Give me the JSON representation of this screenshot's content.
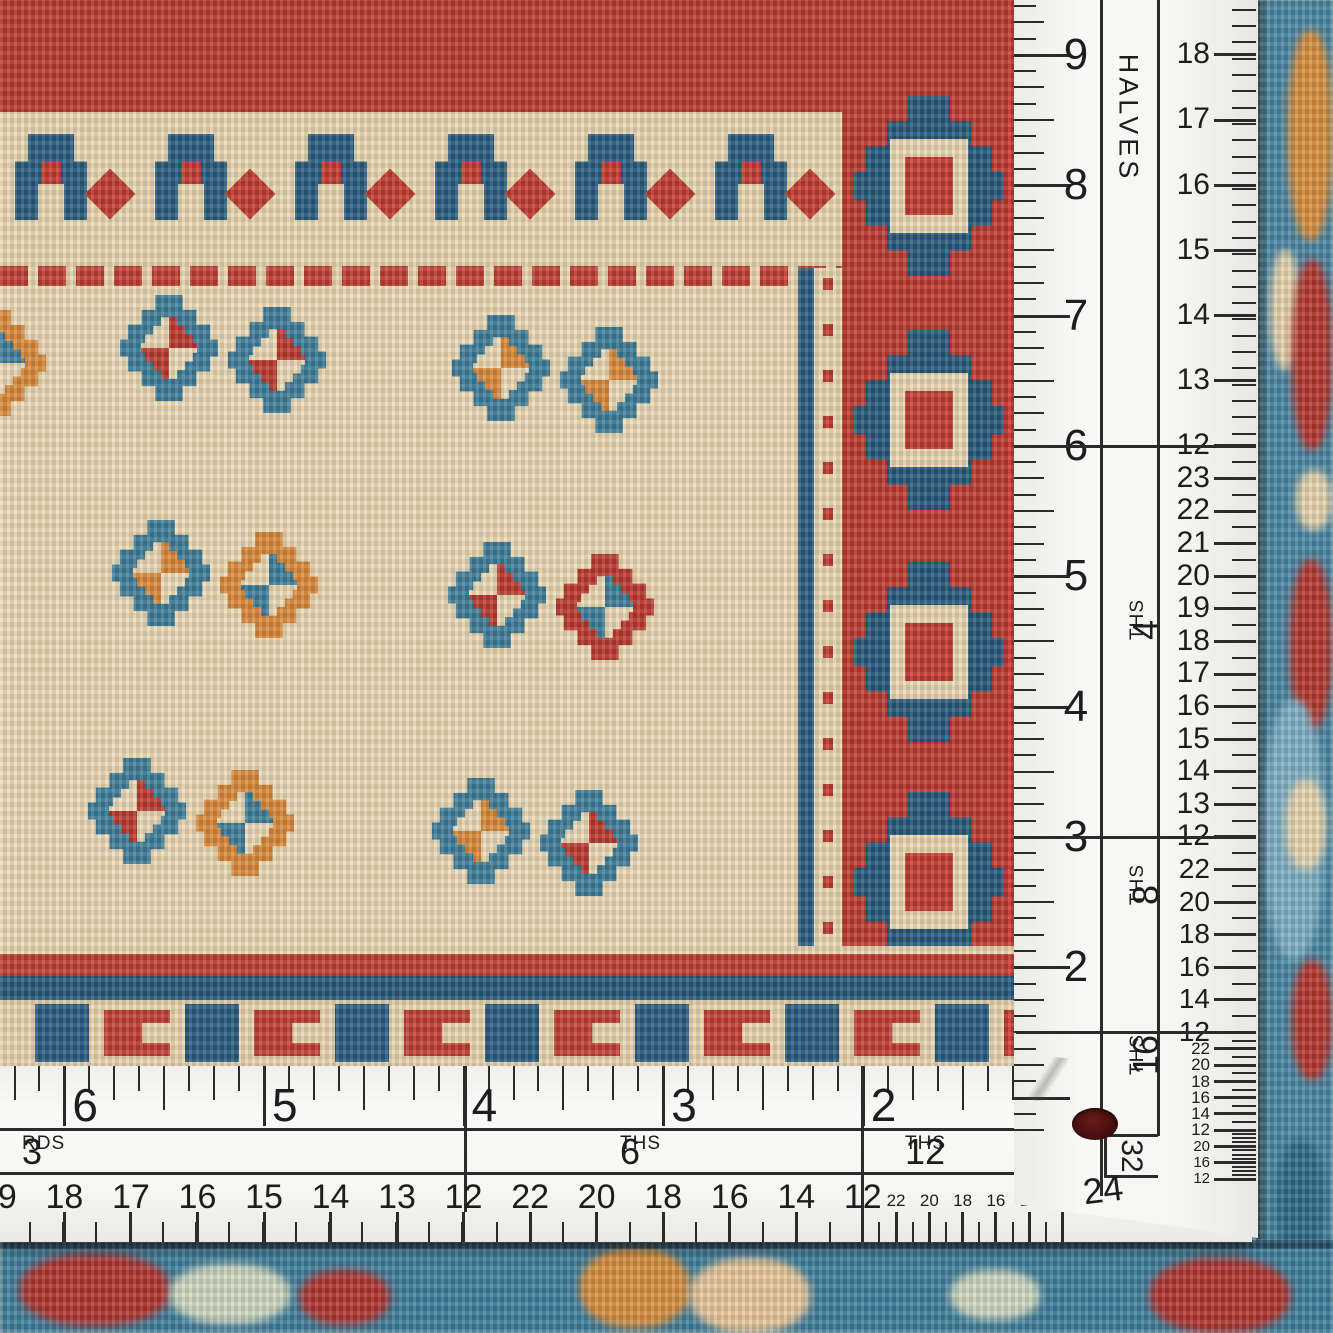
{
  "vertical_ruler": {
    "inch_numbers": [
      "9",
      "8",
      "7",
      "6",
      "5",
      "4",
      "3",
      "2"
    ],
    "sections": [
      {
        "prefix": "",
        "suffix": "HALVES",
        "numbers": [
          "19",
          "18",
          "17",
          "16",
          "15",
          "14",
          "13",
          "12"
        ]
      },
      {
        "prefix": "4",
        "suffix": "THS",
        "numbers": [
          "23",
          "22",
          "21",
          "20",
          "19",
          "18",
          "17",
          "16",
          "15",
          "14",
          "13",
          "12"
        ]
      },
      {
        "prefix": "8",
        "suffix": "THS",
        "numbers": [
          "22",
          "20",
          "18",
          "16",
          "14",
          "12"
        ]
      },
      {
        "prefix": "16",
        "suffix": "THS",
        "numbers": [
          "22",
          "20",
          "18",
          "16",
          "14",
          "12"
        ]
      },
      {
        "prefix": "32",
        "suffix": "",
        "numbers": [
          "20",
          "16",
          "12"
        ]
      }
    ],
    "corner_number_24": "24",
    "corner_number_32": "32"
  },
  "horizontal_ruler": {
    "inch_numbers": [
      "6",
      "5",
      "4",
      "3",
      "2"
    ],
    "sections": [
      {
        "prefix": "3",
        "suffix": "RDS",
        "numbers": [
          "19",
          "18",
          "17",
          "16",
          "15",
          "14",
          "13",
          "12"
        ]
      },
      {
        "prefix": "6",
        "suffix": "THS",
        "numbers": [
          "22",
          "20",
          "18",
          "16",
          "14",
          "12"
        ]
      },
      {
        "prefix": "12",
        "suffix": "THS",
        "numbers": [
          "22",
          "20",
          "18",
          "16",
          "14",
          "12"
        ]
      }
    ]
  },
  "colors": {
    "ruler_white": "#f6f6f3",
    "ruler_ink": "#2b2b2b",
    "rug_red": "#bc3a30",
    "rug_navy": "#2a5c7e",
    "rug_steel_blue": "#3e7d99",
    "rug_cream": "#ebd9b5",
    "rug_orange": "#d9893b",
    "rug_teal": "#3f7e9c",
    "rivet_maroon": "#3f0d0d"
  }
}
